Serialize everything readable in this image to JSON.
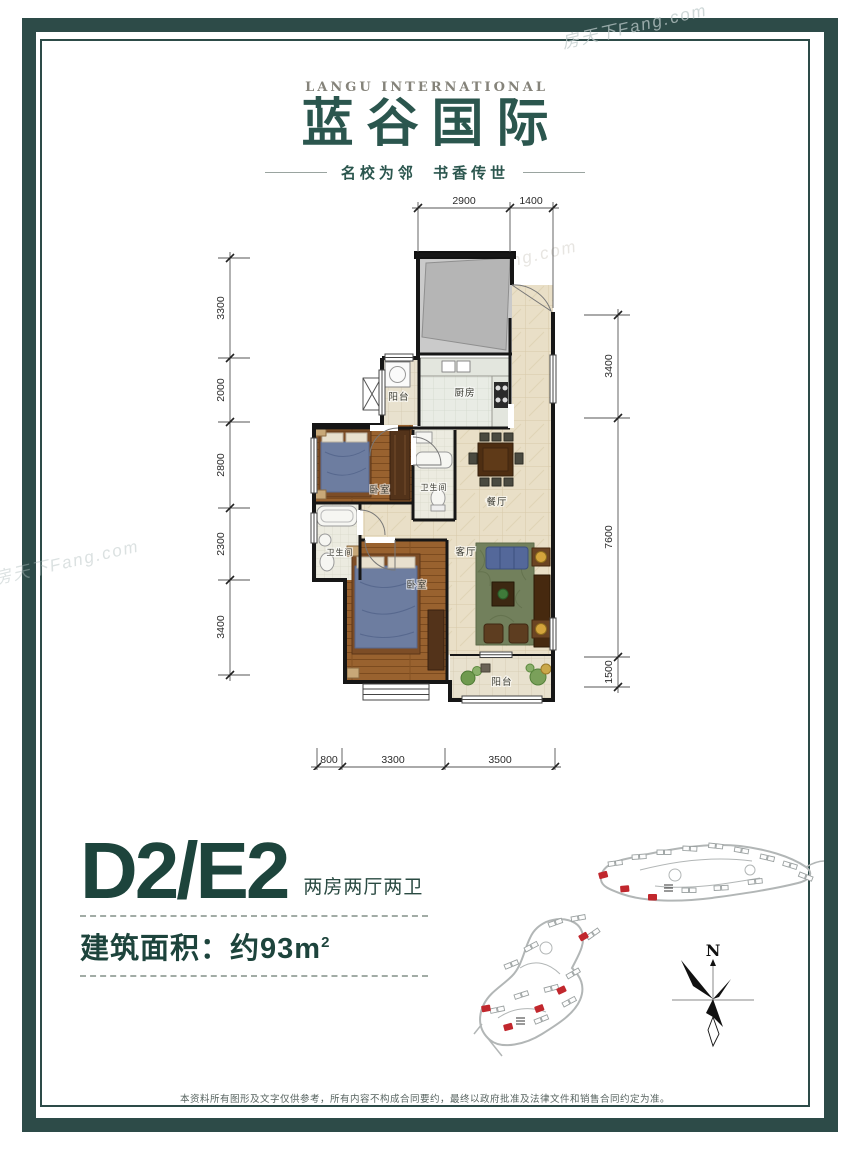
{
  "watermark": {
    "text": "房天下Fang.com"
  },
  "logo": {
    "en": "LANGU INTERNATIONAL",
    "cn": "蓝谷国际",
    "tagline": "名校为邻  书香传世"
  },
  "plan": {
    "rooms": {
      "balcony_top": "阳台",
      "kitchen": "厨房",
      "bedroom_1": "卧室",
      "bath_1": "卫生间",
      "dining": "餐厅",
      "bath_2": "卫生间",
      "living": "客厅",
      "bedroom_2": "卧室",
      "balcony_bottom": "阳台"
    },
    "dims": {
      "top": [
        "2900",
        "1400"
      ],
      "left": [
        "3300",
        "2000",
        "2800",
        "2300",
        "3400"
      ],
      "right": [
        "3400",
        "7600",
        "1500"
      ],
      "bottom": [
        "800",
        "3300",
        "3500"
      ]
    }
  },
  "unit": {
    "title": "D2/E2",
    "layout_desc": "两房两厅两卫",
    "area_label": "建筑面积：",
    "area_value": "约93m",
    "area_sup": "2"
  },
  "sitemap": {
    "north": "N"
  },
  "footer": {
    "disclaimer": "本资料所有图形及文字仅供参考，所有内容不构成合同要约，最终以政府批准及法律文件和销售合同约定为准。"
  },
  "colors": {
    "frame": "#2d4b48",
    "brand_teal": "#2b564e",
    "title_teal": "#1d443c",
    "highlight_red": "#c1272d"
  }
}
